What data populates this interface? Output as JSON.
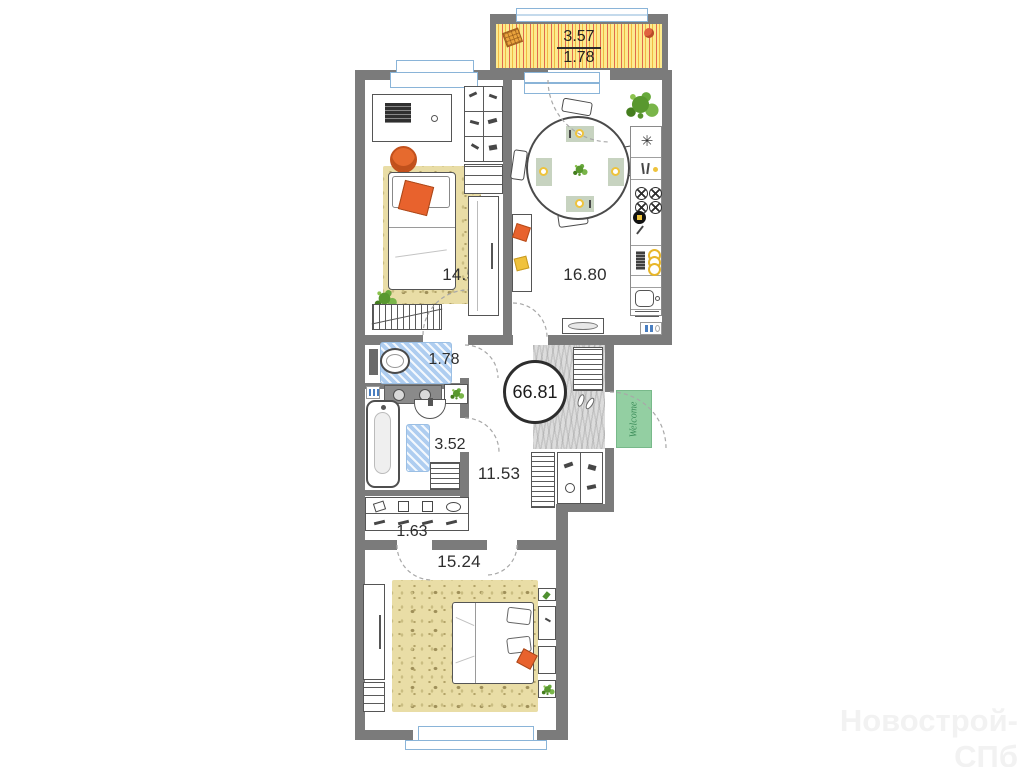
{
  "plan": {
    "balcony": {
      "area_total": "3.57",
      "area_reduced": "1.78"
    },
    "rooms": {
      "bedroom_top": "14.53",
      "kitchen": "16.80",
      "wc": "1.78",
      "bathroom": "3.52",
      "hallway": "11.53",
      "closet": "1.63",
      "bedroom_bottom": "15.24"
    },
    "total_area": "66.81",
    "welcome_mat": "Welcome"
  },
  "watermark": "Новострой-СПб",
  "colors": {
    "wall": "#7b7b7b",
    "rug": "#e9dda6",
    "balcony_stripe_yellow": "#fceb8e",
    "balcony_stripe_orange": "#f2b844",
    "balcony_stripe_red": "#e2694e",
    "bath_mat_blue": "#aecdf0",
    "welcome_green": "#93cfa2",
    "accent_orange": "#e8622d",
    "accent_yellow": "#f0c23c",
    "plant_green": "#59982f",
    "window_blue": "#8ab4d8",
    "entry_mat_gray": "#dcdcdc"
  }
}
